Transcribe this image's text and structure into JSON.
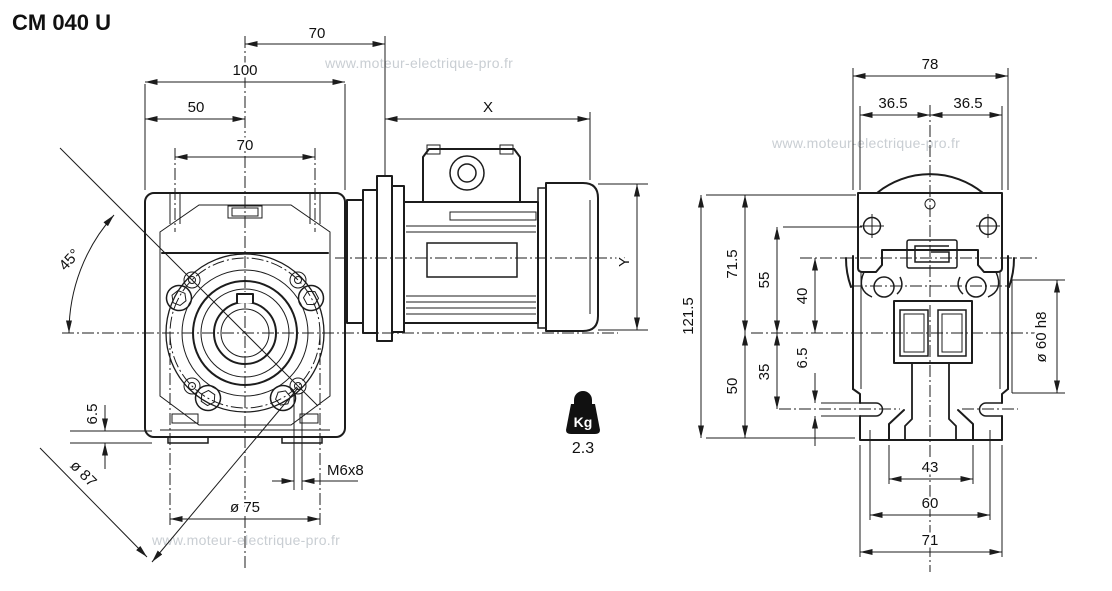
{
  "page": {
    "title": "CM 040 U",
    "watermark": "www.moteur-electrique-pro.fr"
  },
  "colors": {
    "ink": "#1c1c1c",
    "watermark_gray": "#c9ced3"
  },
  "weight": {
    "unit": "Kg",
    "value": "2.3"
  },
  "side_view": {
    "dim_70_top": "70",
    "dim_100": "100",
    "dim_50": "50",
    "dim_70_holes": "70",
    "dim_x": "X",
    "dim_y": "Y",
    "dim_45deg": "45°",
    "dim_6_5": "6.5",
    "dim_dia87": "ø 87",
    "dim_dia75": "ø 75",
    "dim_m6x8": "M6x8"
  },
  "rear_view": {
    "dim_78": "78",
    "dim_36_5_left": "36.5",
    "dim_36_5_right": "36.5",
    "dim_121_5": "121.5",
    "dim_71_5": "71.5",
    "dim_55": "55",
    "dim_40": "40",
    "dim_50": "50",
    "dim_35": "35",
    "dim_6_5": "6.5",
    "dim_dia60h8": "ø 60 h8",
    "dim_43": "43",
    "dim_60": "60",
    "dim_71": "71"
  }
}
